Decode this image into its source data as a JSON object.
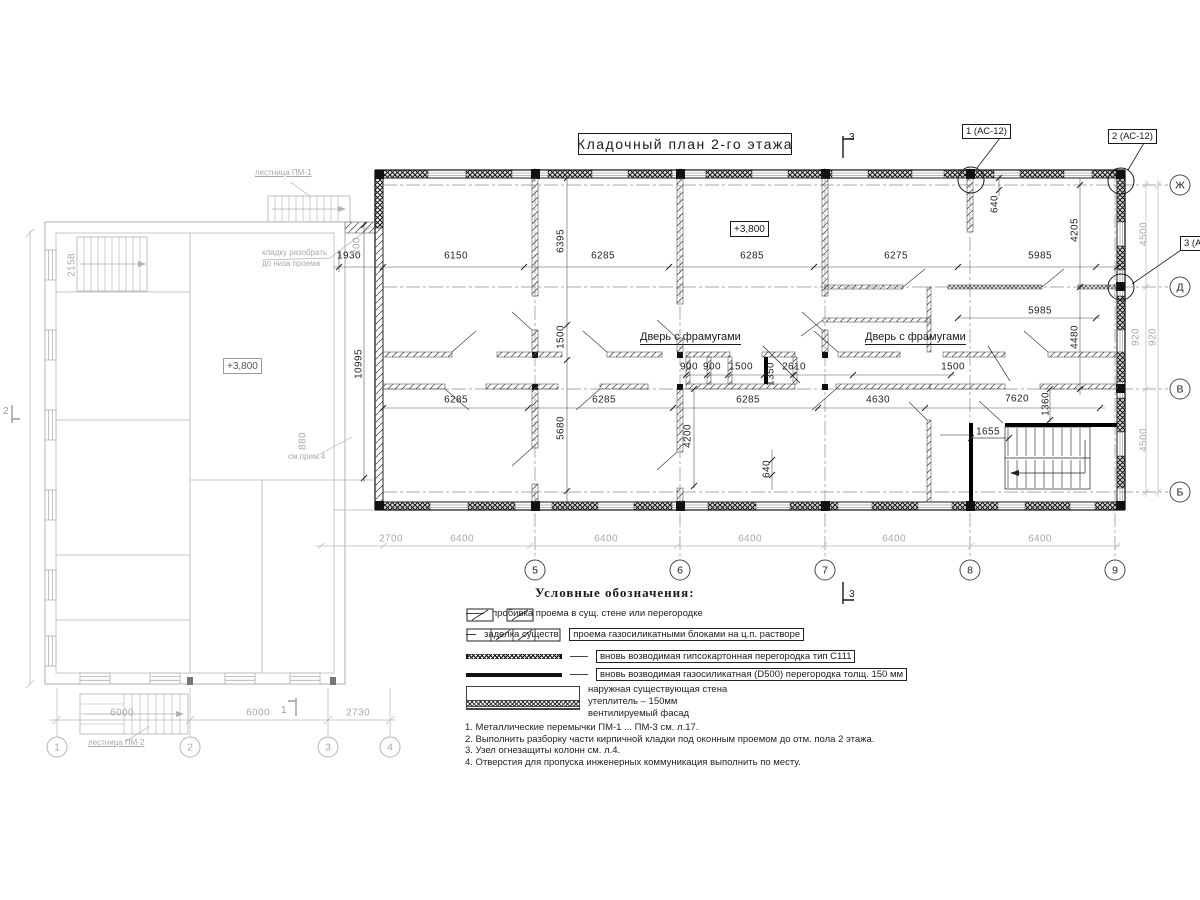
{
  "title": "Кладочный план 2-го этажа",
  "plan": {
    "elevation_main": "+3,800",
    "elevation_left": "+3,800",
    "door_label_1": "Дверь с фрамугами",
    "door_label_2": "Дверь с фрамугами",
    "stair_label_1": "лестница ПМ-1",
    "stair_label_2": "лестница ПМ-2",
    "demolish_note_line1": "кладку разобрать",
    "demolish_note_line2": "до низа проема",
    "see_note": "см.прим.4",
    "callout_1": "1 (АС-12)",
    "callout_2": "2 (АС-12)",
    "callout_3": "3 (АС-12)"
  },
  "section_marks": {
    "top": "3",
    "bottom": "3",
    "left_building": "1",
    "far_left": "2"
  },
  "axes": {
    "bottom": [
      {
        "label": "5",
        "x": 535,
        "y": 570
      },
      {
        "label": "6",
        "x": 680,
        "y": 570
      },
      {
        "label": "7",
        "x": 825,
        "y": 570
      },
      {
        "label": "8",
        "x": 970,
        "y": 570
      },
      {
        "label": "9",
        "x": 1115,
        "y": 570
      }
    ],
    "right": [
      {
        "label": "Ж",
        "x": 1180,
        "y": 185
      },
      {
        "label": "Д",
        "x": 1180,
        "y": 287
      },
      {
        "label": "В",
        "x": 1180,
        "y": 389
      },
      {
        "label": "Б",
        "x": 1180,
        "y": 492
      }
    ],
    "left": [
      {
        "label": "1",
        "x": 57,
        "y": 747
      },
      {
        "label": "2",
        "x": 190,
        "y": 747
      },
      {
        "label": "3",
        "x": 328,
        "y": 747
      },
      {
        "label": "4",
        "x": 390,
        "y": 747
      }
    ]
  },
  "dims": [
    {
      "t": "1930",
      "x": 349,
      "y": 256
    },
    {
      "t": "6150",
      "x": 456,
      "y": 256
    },
    {
      "t": "6285",
      "x": 603,
      "y": 256
    },
    {
      "t": "6285",
      "x": 752,
      "y": 256
    },
    {
      "t": "6275",
      "x": 896,
      "y": 256
    },
    {
      "t": "5985",
      "x": 1040,
      "y": 256
    },
    {
      "t": "5985",
      "x": 1040,
      "y": 311
    },
    {
      "t": "900",
      "x": 689,
      "y": 367
    },
    {
      "t": "900",
      "x": 712,
      "y": 367
    },
    {
      "t": "1500",
      "x": 741,
      "y": 367
    },
    {
      "t": "2610",
      "x": 794,
      "y": 367
    },
    {
      "t": "1350",
      "x": 771,
      "y": 374,
      "r": 1
    },
    {
      "t": "1500",
      "x": 953,
      "y": 367
    },
    {
      "t": "6285",
      "x": 456,
      "y": 400
    },
    {
      "t": "6285",
      "x": 604,
      "y": 400
    },
    {
      "t": "6285",
      "x": 748,
      "y": 400
    },
    {
      "t": "4630",
      "x": 878,
      "y": 400
    },
    {
      "t": "7620",
      "x": 1017,
      "y": 399
    },
    {
      "t": "1655",
      "x": 988,
      "y": 432
    },
    {
      "t": "1360",
      "x": 1046,
      "y": 404,
      "r": 1
    },
    {
      "t": "6395",
      "x": 561,
      "y": 241,
      "r": 1
    },
    {
      "t": "1500",
      "x": 561,
      "y": 337,
      "r": 1
    },
    {
      "t": "10995",
      "x": 359,
      "y": 364,
      "r": 1
    },
    {
      "t": "5680",
      "x": 561,
      "y": 428,
      "r": 1
    },
    {
      "t": "4200",
      "x": 688,
      "y": 436,
      "r": 1
    },
    {
      "t": "640",
      "x": 767,
      "y": 469,
      "r": 1
    },
    {
      "t": "640",
      "x": 995,
      "y": 204,
      "r": 1
    },
    {
      "t": "4205",
      "x": 1075,
      "y": 230,
      "r": 1
    },
    {
      "t": "4480",
      "x": 1075,
      "y": 337,
      "r": 1
    },
    {
      "t": "200",
      "x": 357,
      "y": 246,
      "r": 1,
      "c": "g"
    },
    {
      "t": "2700",
      "x": 391,
      "y": 539,
      "c": "g"
    },
    {
      "t": "6400",
      "x": 462,
      "y": 539,
      "c": "g"
    },
    {
      "t": "6400",
      "x": 606,
      "y": 539,
      "c": "g"
    },
    {
      "t": "6400",
      "x": 750,
      "y": 539,
      "c": "g"
    },
    {
      "t": "6400",
      "x": 894,
      "y": 539,
      "c": "g"
    },
    {
      "t": "6400",
      "x": 1040,
      "y": 539,
      "c": "g"
    },
    {
      "t": "4500",
      "x": 1144,
      "y": 234,
      "r": 1,
      "c": "g"
    },
    {
      "t": "920",
      "x": 1136,
      "y": 337,
      "r": 1,
      "c": "g"
    },
    {
      "t": "920",
      "x": 1153,
      "y": 337,
      "r": 1,
      "c": "g"
    },
    {
      "t": "4500",
      "x": 1144,
      "y": 440,
      "r": 1,
      "c": "g"
    },
    {
      "t": "2158",
      "x": 72,
      "y": 265,
      "r": 1,
      "c": "g"
    },
    {
      "t": "880",
      "x": 303,
      "y": 441,
      "r": 1,
      "c": "g"
    },
    {
      "t": "6000",
      "x": 122,
      "y": 713,
      "c": "g"
    },
    {
      "t": "6000",
      "x": 258,
      "y": 713,
      "c": "g"
    },
    {
      "t": "2730",
      "x": 358,
      "y": 713,
      "c": "g"
    }
  ],
  "legend": {
    "title": "Условные обозначения:",
    "item1": "пробивка проема  в сущ. стене  или перегородке",
    "item2_plain": "заделка существ.",
    "item2_boxed": "проема газосиликатными блоками на ц.п. растворе",
    "item3": "вновь возводимая гипсокартонная перегородка тип С111",
    "item4": "вновь возводимая газосиликатная (D500) перегородка толщ. 150 мм",
    "item5a": "наружная существующая стена",
    "item5b": "утеплитель – 150мм",
    "item5c": "вентилируемый фасад"
  },
  "notes": [
    "1. Металлические перемычки  ПМ-1 ... ПМ-3 см. л.17.",
    "2. Выполнить разборку части кирпичной кладки под оконным проемом до отм. пола 2 этажа.",
    "3. Узел огнезащиты колонн см. л.4.",
    "4. Отверстия для пропуска инженерных коммуникация выполнить по месту."
  ]
}
